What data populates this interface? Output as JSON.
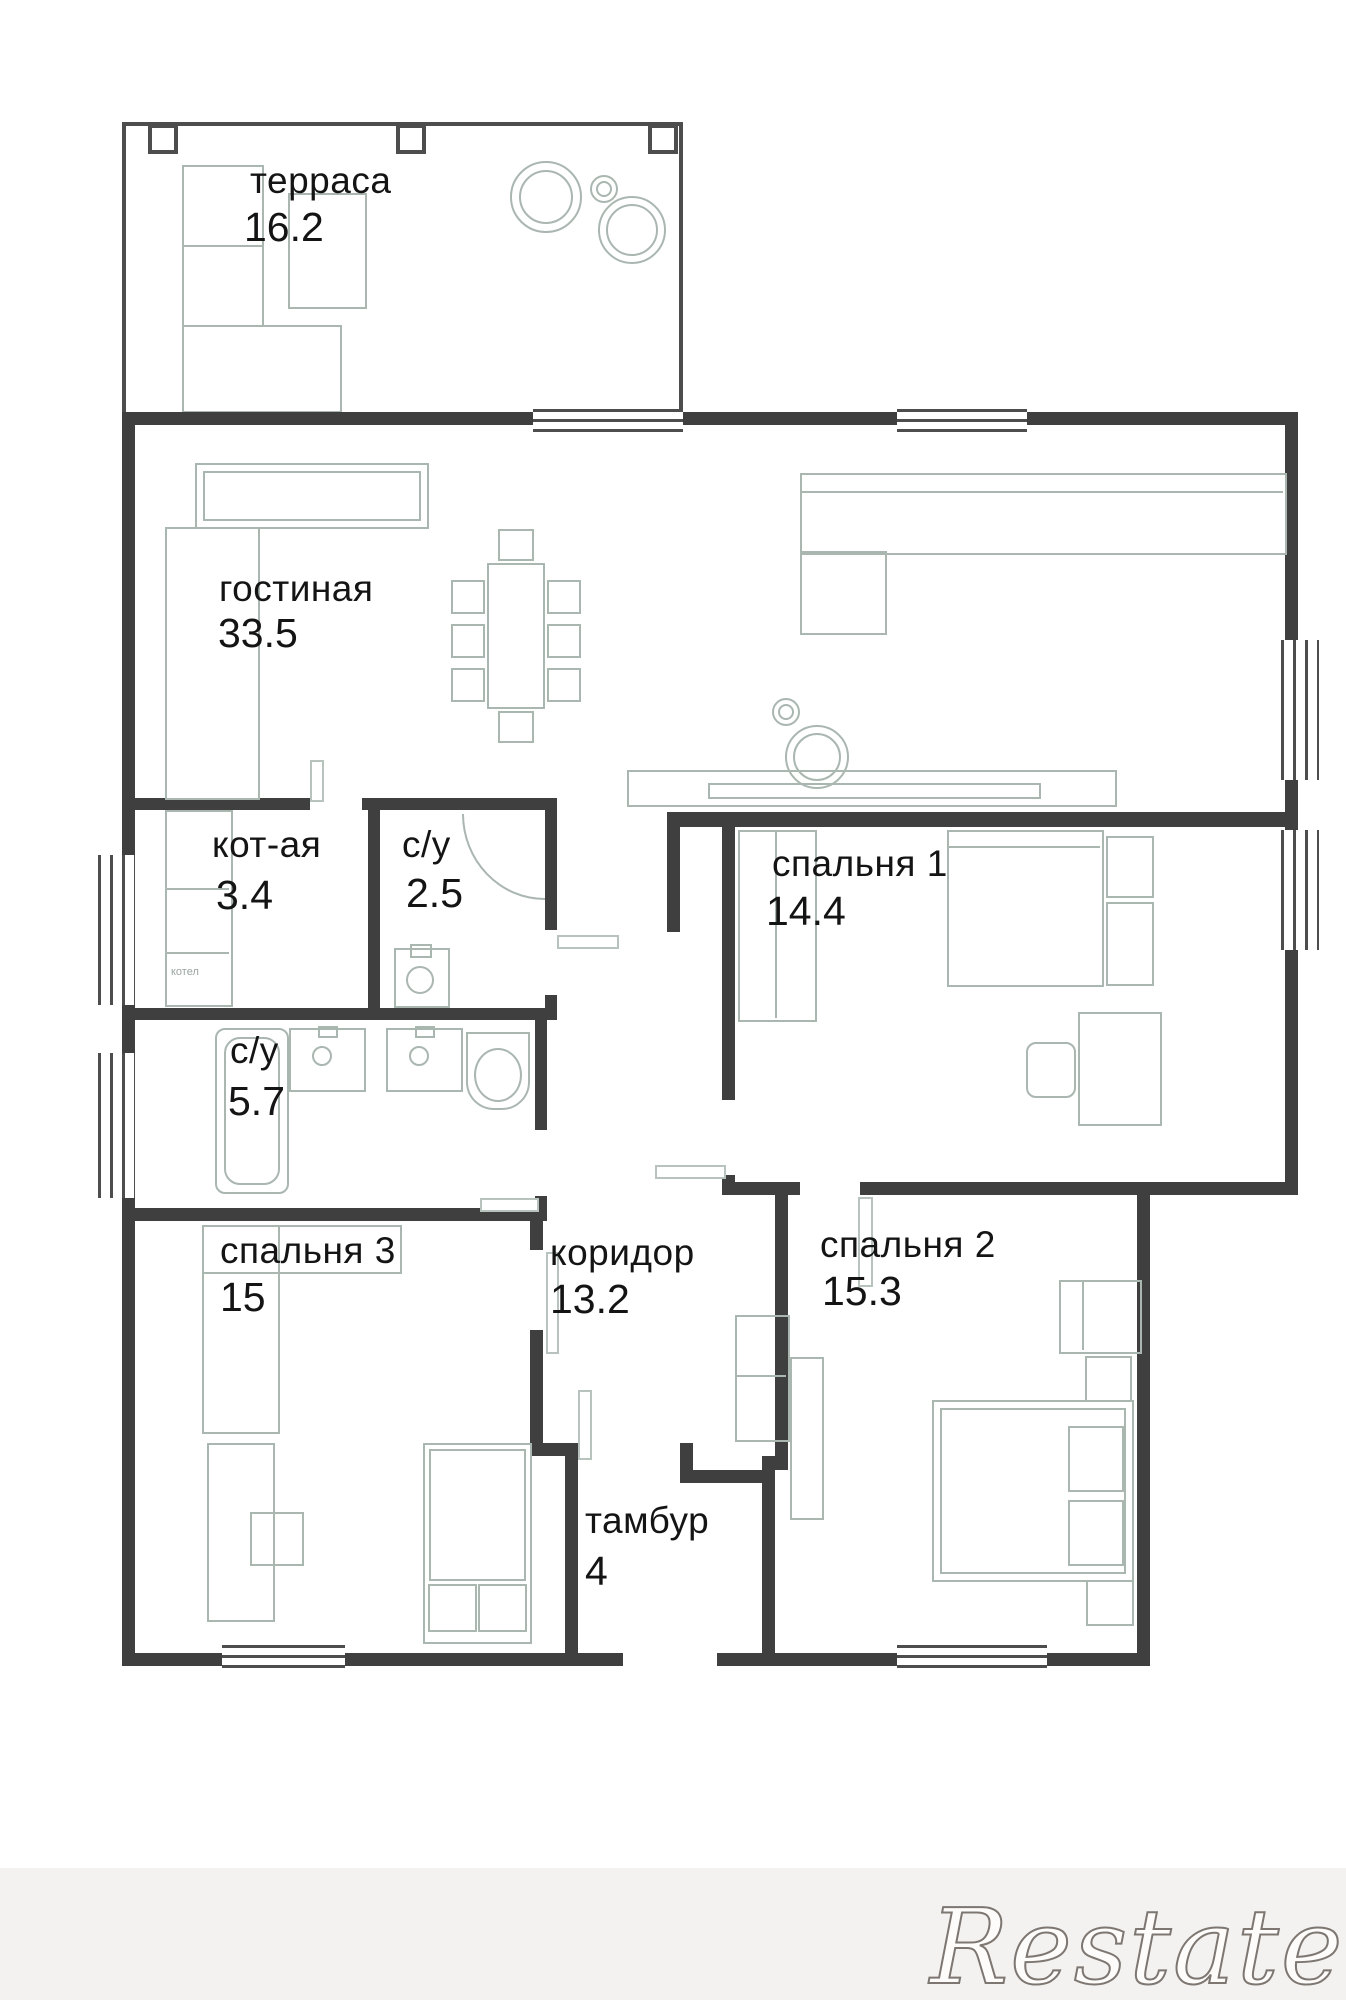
{
  "plan": {
    "rooms": [
      {
        "id": "terrace",
        "label": "терраса",
        "area": "16.2"
      },
      {
        "id": "living",
        "label": "гостиная",
        "area": "33.5"
      },
      {
        "id": "boiler",
        "label": "кот-ая",
        "area": "3.4"
      },
      {
        "id": "wc_small",
        "label": "с/у",
        "area": "2.5"
      },
      {
        "id": "bedroom1",
        "label": "спальня 1",
        "area": "14.4"
      },
      {
        "id": "wc_big",
        "label": "с/у",
        "area": "5.7"
      },
      {
        "id": "bedroom3",
        "label": "спальня 3",
        "area": "15"
      },
      {
        "id": "hall",
        "label": "коридор",
        "area": "13.2"
      },
      {
        "id": "bedroom2",
        "label": "спальня 2",
        "area": "15.3"
      },
      {
        "id": "vestibule",
        "label": "тамбур",
        "area": "4"
      }
    ],
    "annotations": {
      "boiler_unit": "котел"
    },
    "watermark": "Restate",
    "colors": {
      "wall": "#3f3f3f",
      "furniture": "#aab6b0",
      "text": "#141414",
      "watermark_fill": "#fdfcfb",
      "watermark_stroke": "#7d7671"
    }
  }
}
